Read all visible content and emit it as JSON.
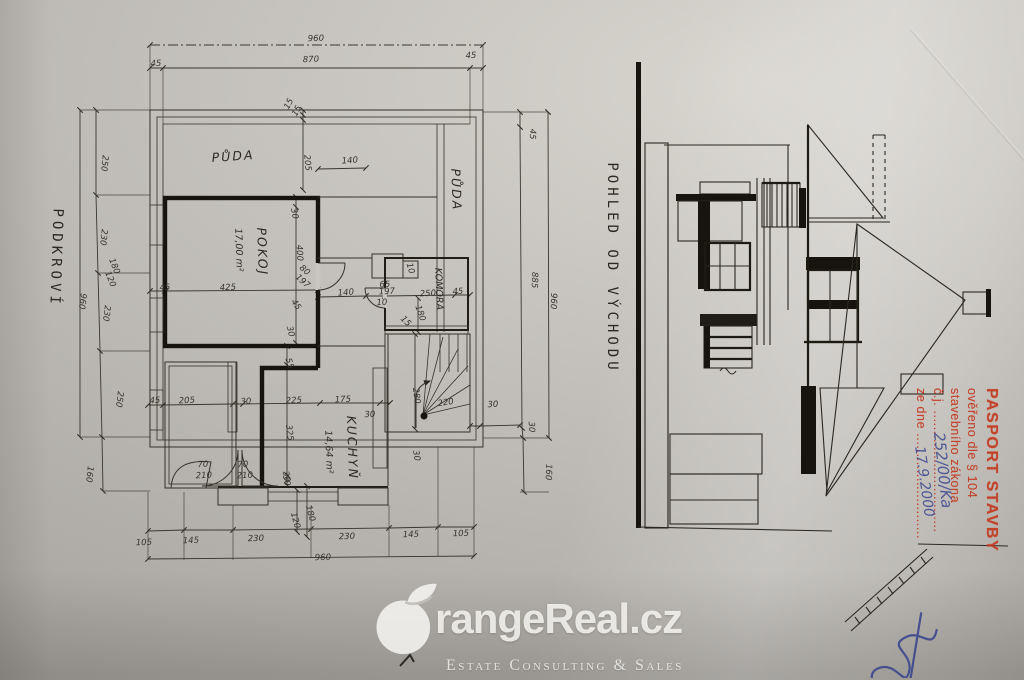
{
  "plan": {
    "floor_label": "PODKROVÍ",
    "rooms": [
      {
        "label": "PŮDA"
      },
      {
        "label": "PŮDA"
      },
      {
        "label": "POKOJ",
        "area": "17,00 m²"
      },
      {
        "label": "KOMORA"
      },
      {
        "label": "KUCHYŇ",
        "area": "14,64 m²"
      }
    ],
    "dims": [
      {
        "t": "960",
        "x": 316,
        "y": 41,
        "r": -2
      },
      {
        "t": "45",
        "x": 156,
        "y": 66,
        "r": -2
      },
      {
        "t": "870",
        "x": 311,
        "y": 62,
        "r": -2
      },
      {
        "t": "45",
        "x": 471,
        "y": 58,
        "r": -2
      },
      {
        "t": "15",
        "x": 291,
        "y": 105,
        "r": -62
      },
      {
        "t": "15",
        "x": 299,
        "y": 112,
        "r": -62
      },
      {
        "t": "205",
        "x": 305,
        "y": 163,
        "r": 85
      },
      {
        "t": "140",
        "x": 350,
        "y": 163,
        "r": -4
      },
      {
        "t": "250",
        "x": 102,
        "y": 163,
        "r": 96
      },
      {
        "t": "230",
        "x": 101,
        "y": 237,
        "r": 96
      },
      {
        "t": "180",
        "x": 112,
        "y": 267,
        "r": 68
      },
      {
        "t": "120",
        "x": 108,
        "y": 280,
        "r": 68
      },
      {
        "t": "960",
        "x": 80,
        "y": 301,
        "r": 97
      },
      {
        "t": "230",
        "x": 104,
        "y": 313,
        "r": 97
      },
      {
        "t": "250",
        "x": 117,
        "y": 399,
        "r": 97
      },
      {
        "t": "160",
        "x": 87,
        "y": 474,
        "r": 96
      },
      {
        "t": "45",
        "x": 530,
        "y": 134,
        "r": 92
      },
      {
        "t": "885",
        "x": 532,
        "y": 280,
        "r": 92
      },
      {
        "t": "960",
        "x": 551,
        "y": 301,
        "r": 92
      },
      {
        "t": "30",
        "x": 529,
        "y": 427,
        "r": 88
      },
      {
        "t": "160",
        "x": 546,
        "y": 472,
        "r": 92
      },
      {
        "t": "105",
        "x": 144,
        "y": 545,
        "r": -2
      },
      {
        "t": "145",
        "x": 191,
        "y": 543,
        "r": -2
      },
      {
        "t": "230",
        "x": 256,
        "y": 541,
        "r": -2
      },
      {
        "t": "230",
        "x": 347,
        "y": 539,
        "r": -2
      },
      {
        "t": "145",
        "x": 411,
        "y": 537,
        "r": -2
      },
      {
        "t": "105",
        "x": 461,
        "y": 536,
        "r": -2
      },
      {
        "t": "960",
        "x": 323,
        "y": 560,
        "r": -2
      },
      {
        "t": "120",
        "x": 293,
        "y": 521,
        "r": 75
      },
      {
        "t": "180",
        "x": 308,
        "y": 514,
        "r": 75
      },
      {
        "t": "30",
        "x": 284,
        "y": 481,
        "r": 78
      },
      {
        "t": "30",
        "x": 292,
        "y": 214,
        "r": 80
      },
      {
        "t": "400",
        "x": 297,
        "y": 253,
        "r": 87
      },
      {
        "t": "80",
        "x": 303,
        "y": 272,
        "r": 42
      },
      {
        "t": "197",
        "x": 301,
        "y": 283,
        "r": 42
      },
      {
        "t": "45",
        "x": 165,
        "y": 290,
        "r": -3
      },
      {
        "t": "425",
        "x": 228,
        "y": 290,
        "r": -3
      },
      {
        "t": "45",
        "x": 294,
        "y": 306,
        "r": 55
      },
      {
        "t": "30",
        "x": 288,
        "y": 332,
        "r": 76
      },
      {
        "t": "140",
        "x": 346,
        "y": 295,
        "r": -4
      },
      {
        "t": "10",
        "x": 408,
        "y": 269,
        "r": 74
      },
      {
        "t": "65",
        "x": 385,
        "y": 287,
        "r": -3
      },
      {
        "t": "197",
        "x": 387,
        "y": 294,
        "r": -3
      },
      {
        "t": "10",
        "x": 382,
        "y": 305,
        "r": -3
      },
      {
        "t": "250",
        "x": 428,
        "y": 296,
        "r": -3
      },
      {
        "t": "45",
        "x": 458,
        "y": 294,
        "r": -3
      },
      {
        "t": "180",
        "x": 418,
        "y": 314,
        "r": 70
      },
      {
        "t": "15",
        "x": 404,
        "y": 323,
        "r": 45
      },
      {
        "t": "55",
        "x": 287,
        "y": 364,
        "r": 74
      },
      {
        "t": "45",
        "x": 155,
        "y": 403,
        "r": -3
      },
      {
        "t": "205",
        "x": 187,
        "y": 403,
        "r": -3
      },
      {
        "t": "30",
        "x": 246,
        "y": 404,
        "r": -3
      },
      {
        "t": "225",
        "x": 294,
        "y": 403,
        "r": -3
      },
      {
        "t": "175",
        "x": 343,
        "y": 402,
        "r": -3
      },
      {
        "t": "30",
        "x": 370,
        "y": 417,
        "r": -3
      },
      {
        "t": "325",
        "x": 287,
        "y": 433,
        "r": 83
      },
      {
        "t": "30",
        "x": 284,
        "y": 477,
        "r": 76
      },
      {
        "t": "70",
        "x": 203,
        "y": 467,
        "r": -3
      },
      {
        "t": "210",
        "x": 204,
        "y": 478,
        "r": -3
      },
      {
        "t": "70",
        "x": 243,
        "y": 467,
        "r": -3
      },
      {
        "t": "210",
        "x": 245,
        "y": 478,
        "r": -3
      },
      {
        "t": "280",
        "x": 414,
        "y": 396,
        "r": 83
      },
      {
        "t": "220",
        "x": 446,
        "y": 405,
        "r": -8
      },
      {
        "t": "30",
        "x": 493,
        "y": 407,
        "r": -3
      },
      {
        "t": "30",
        "x": 414,
        "y": 456,
        "r": 80
      }
    ]
  },
  "elevation": {
    "title": "POHLED OD VÝCHODU"
  },
  "stamp": {
    "line1": "PASPORT STAVBY",
    "line2": "ověřeno dle § 104",
    "line3": "stavebního zákona",
    "line4": "č.j. ..............................",
    "line5": "ze dne ..........................",
    "handwritten_cj": "252/00/Ka",
    "handwritten_date": "17.9.2000",
    "stamp_color": "#c43a20",
    "ink_color": "#36418d"
  },
  "watermark": {
    "brand": "rangeReal.cz",
    "tagline": "Estate Consulting & Sales"
  }
}
